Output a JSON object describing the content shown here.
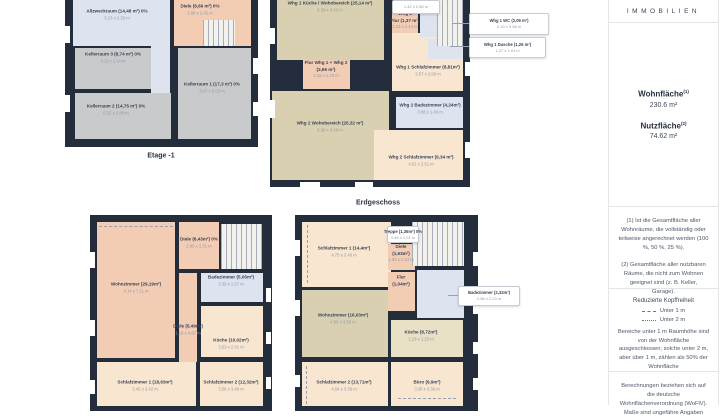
{
  "colors": {
    "wall": "#242d3c",
    "tan": "#d9d0b2",
    "tan_light": "#e9e1c6",
    "cream": "#f8e6d0",
    "salmon": "#f2cdb4",
    "blue": "#dde4f0",
    "gray": "#c9cacb"
  },
  "plans": [
    {
      "id": "etage-minus-1",
      "frame": [
        65,
        -6,
        193,
        153
      ],
      "rooms": [
        {
          "key": "allzweckraum",
          "color": "blue",
          "rect": [
            73,
            0,
            97,
            46
          ],
          "label_at": [
            117,
            15
          ],
          "name_lines": [
            "Allzweckraum (14,48 m²) 0%"
          ],
          "dim": "5.23 x 2.36 m"
        },
        {
          "key": "kellerflur",
          "color": "blue",
          "rect": [
            151,
            46,
            19,
            57
          ],
          "name_lines": []
        },
        {
          "key": "diele-keller",
          "color": "salmon",
          "rect": [
            174,
            0,
            77,
            46
          ],
          "label_at": [
            200,
            10
          ],
          "name_lines": [
            "Diele (8,69 m²) 0%"
          ],
          "dim": "2.88 x 2.42 m"
        },
        {
          "key": "kellerraum-3",
          "color": "gray",
          "rect": [
            75,
            48,
            76,
            41
          ],
          "label_at": [
            113,
            58
          ],
          "name_lines": [
            "Kellerraum 3 (8,74 m²) 0%"
          ],
          "dim": "4.11 x 2.14 m"
        },
        {
          "key": "kellerraum-1",
          "color": "gray",
          "rect": [
            178,
            48,
            73,
            91
          ],
          "label_at": [
            212,
            88
          ],
          "name_lines": [
            "Kellerraum 1 (17,3 m²) 0%"
          ],
          "dim": "3.47 x 5.03 m"
        },
        {
          "key": "kellerraum-2",
          "color": "gray",
          "rect": [
            75,
            93,
            96,
            46
          ],
          "label_at": [
            116,
            110
          ],
          "name_lines": [
            "Kellerraum 2 (14,75 m²) 0%"
          ],
          "dim": "5.25 x 2.80 m"
        }
      ],
      "stairs": [
        [
          203,
          20,
          32,
          26
        ]
      ],
      "windows": [
        [
          65,
          26,
          5,
          17
        ],
        [
          65,
          95,
          5,
          17
        ],
        [
          253,
          58,
          5,
          16
        ],
        [
          253,
          102,
          5,
          14
        ]
      ]
    },
    {
      "id": "erdgeschoss",
      "frame": [
        270,
        -6,
        200,
        193
      ],
      "rooms": [
        {
          "key": "whg1-kueche-wohnbereich",
          "color": "tan",
          "rect": [
            277,
            0,
            107,
            60
          ],
          "label_at": [
            330,
            7
          ],
          "name_lines": [
            "Whg 1 Küche / Wohnbereich (25,14 m²)"
          ],
          "dim": "5.39 x 4.63 m"
        },
        {
          "key": "whg1-schlafzimmer",
          "color": "cream",
          "rect": [
            392,
            33,
            71,
            58
          ],
          "label_at": [
            428,
            71
          ],
          "name_lines": [
            "Whg 1 Schlafzimmer (8,81m²)"
          ],
          "dim": "3.57 x 2.89 m"
        },
        {
          "key": "whg1-wc",
          "color": "blue",
          "rect": [
            420,
            13,
            43,
            24
          ],
          "name_lines": []
        },
        {
          "key": "whg1-dusche",
          "color": "blue",
          "rect": [
            428,
            39,
            35,
            20
          ],
          "name_lines": []
        },
        {
          "key": "whg1-flur",
          "color": "salmon",
          "rect": [
            392,
            13,
            26,
            20
          ],
          "label_at": [
            405,
            21
          ],
          "name_lines": [
            "Whg 1",
            "Flur (1,37 m²)"
          ],
          "dim": "1.22 x 1.14 m"
        },
        {
          "key": "flur-whg1-whg2",
          "color": "salmon",
          "rect": [
            303,
            60,
            47,
            29
          ],
          "label_at": [
            326,
            70
          ],
          "name_lines": [
            "Flur Whg 1 + Whg 2",
            "(2,66 m²)"
          ],
          "dim": "2.18 x 1.23 m"
        },
        {
          "key": "whg2-wohnbereich",
          "color": "tan",
          "rect": [
            272,
            91,
            117,
            89
          ],
          "label_at": [
            330,
            127
          ],
          "name_lines": [
            "Whg 2 Wohnbereich (25,32 m²)"
          ],
          "dim": "5.36 x 4.59 m"
        },
        {
          "key": "whg2-badezimmer",
          "color": "blue",
          "rect": [
            396,
            97,
            67,
            31
          ],
          "label_at": [
            430,
            109
          ],
          "name_lines": [
            "Whg 2 Badezimmer (4,24m²)"
          ],
          "dim": "3.08 x 1.49 m"
        },
        {
          "key": "whg2-schlafzimmer",
          "color": "cream",
          "rect": [
            374,
            130,
            89,
            50
          ],
          "label_at": [
            421,
            161
          ],
          "name_lines": [
            "Whg 2 Schlafzimmer (9,34 m²)"
          ],
          "dim": "4.51 x 2.51 m"
        }
      ],
      "stairs": [
        [
          437,
          0,
          26,
          46
        ]
      ],
      "windows": [
        [
          270,
          28,
          5,
          16
        ],
        [
          270,
          100,
          5,
          18
        ],
        [
          465,
          62,
          5,
          14
        ],
        [
          465,
          142,
          5,
          16
        ],
        [
          300,
          182,
          20,
          5
        ],
        [
          355,
          182,
          18,
          5
        ]
      ]
    },
    {
      "id": "obergeschoss-links",
      "frame": [
        90,
        215,
        182,
        196
      ],
      "rooms": [
        {
          "key": "wohnzimmer-og1",
          "color": "salmon",
          "rect": [
            97,
            222,
            78,
            136
          ],
          "label_at": [
            136,
            288
          ],
          "name_lines": [
            "Wohnzimmer (29,19m²)"
          ],
          "dim": "4.14 x 7.11 m"
        },
        {
          "key": "diele-643",
          "color": "salmon",
          "rect": [
            179,
            222,
            40,
            47
          ],
          "label_at": [
            199,
            243
          ],
          "name_lines": [
            "Diele (6,43m²) 0%"
          ],
          "dim": "2.95 x 2.31 m"
        },
        {
          "key": "diele-549",
          "color": "salmon",
          "rect": [
            179,
            273,
            18,
            89
          ],
          "label_at": [
            188,
            330
          ],
          "name_lines": [
            "Diele (5,49m²)"
          ],
          "dim": "1.18 x 4.67 m"
        },
        {
          "key": "badezimmer-og1",
          "color": "blue",
          "rect": [
            201,
            273,
            62,
            29
          ],
          "label_at": [
            231,
            281
          ],
          "name_lines": [
            "Badezimmer (5,05m²)"
          ],
          "dim": "3.30 x 1.57 m"
        },
        {
          "key": "kueche-og1",
          "color": "cream",
          "rect": [
            201,
            306,
            62,
            51
          ],
          "label_at": [
            231,
            344
          ],
          "name_lines": [
            "Küche (10,02m²)"
          ],
          "dim": "3.53 x 2.91 m"
        },
        {
          "key": "schlafzimmer-1-og1",
          "color": "cream",
          "rect": [
            97,
            362,
            99,
            44
          ],
          "label_at": [
            145,
            386
          ],
          "name_lines": [
            "Schlafzimmer 1 (18,63m²)"
          ],
          "dim": "5.45 x 3.42 m"
        },
        {
          "key": "schlafzimmer-2-og1",
          "color": "cream",
          "rect": [
            200,
            362,
            63,
            44
          ],
          "label_at": [
            231,
            386
          ],
          "name_lines": [
            "Schlafzimmer 2 (12,32m²)"
          ],
          "dim": "3.58 x 3.49 m"
        }
      ],
      "stairs": [
        [
          221,
          224,
          41,
          45
        ]
      ],
      "windows": [
        [
          90,
          252,
          5,
          16
        ],
        [
          90,
          320,
          5,
          16
        ],
        [
          90,
          380,
          5,
          14
        ],
        [
          266,
          288,
          5,
          14
        ],
        [
          266,
          332,
          5,
          12
        ],
        [
          266,
          377,
          5,
          12
        ]
      ],
      "dashes": [
        [
          99,
          226,
          74,
          0
        ]
      ]
    },
    {
      "id": "obergeschoss-rechts",
      "frame": [
        295,
        215,
        183,
        196
      ],
      "rooms": [
        {
          "key": "schlafzimmer-1-og2",
          "color": "cream",
          "rect": [
            302,
            222,
            89,
            65
          ],
          "label_at": [
            344,
            252
          ],
          "name_lines": [
            "Schlafzimmer 1 (14,4m²)"
          ],
          "dim": "4.75 x 3.48 m"
        },
        {
          "key": "diele-og2",
          "color": "salmon",
          "rect": [
            388,
            244,
            27,
            26
          ],
          "label_at": [
            401,
            254
          ],
          "name_lines": [
            "Diele",
            "(1,63m²)"
          ],
          "dim": "1.31 x 1.24 m"
        },
        {
          "key": "flur-og2",
          "color": "salmon",
          "rect": [
            388,
            272,
            27,
            39
          ],
          "label_at": [
            401,
            281
          ],
          "name_lines": [
            "Flur",
            "(1,04m²)"
          ]
        },
        {
          "key": "badezimmer-og2",
          "color": "blue",
          "rect": [
            417,
            270,
            47,
            48
          ],
          "name_lines": []
        },
        {
          "key": "wohnzimmer-og2",
          "color": "tan",
          "rect": [
            302,
            290,
            86,
            67
          ],
          "label_at": [
            343,
            319
          ],
          "name_lines": [
            "Wohnzimmer (16,03m²)"
          ],
          "dim": "4.56 x 3.56 m"
        },
        {
          "key": "kueche-og2",
          "color": "tan_light",
          "rect": [
            391,
            320,
            72,
            37
          ],
          "label_at": [
            421,
            336
          ],
          "name_lines": [
            "Küche (8,72m²)"
          ],
          "dim": "1.23 x 1.23 m"
        },
        {
          "key": "schlafzimmer-2-og2",
          "color": "cream",
          "rect": [
            302,
            362,
            86,
            44
          ],
          "label_at": [
            344,
            386
          ],
          "name_lines": [
            "Schlafzimmer 2 (13,71m²)"
          ],
          "dim": "4.54 x 3.38 m"
        },
        {
          "key": "buero",
          "color": "cream",
          "rect": [
            391,
            362,
            72,
            44
          ],
          "label_at": [
            427,
            386
          ],
          "name_lines": [
            "Büro (9,9m²)"
          ],
          "dim": "3.30 x 3.36 m"
        }
      ],
      "stairs": [
        [
          412,
          222,
          52,
          44
        ]
      ],
      "windows": [
        [
          295,
          240,
          5,
          16
        ],
        [
          295,
          300,
          5,
          16
        ],
        [
          295,
          375,
          5,
          12
        ],
        [
          473,
          252,
          5,
          14
        ],
        [
          473,
          300,
          5,
          14
        ],
        [
          473,
          342,
          5,
          12
        ],
        [
          473,
          378,
          5,
          12
        ]
      ],
      "dashes": [
        [
          307,
          225,
          0,
          58
        ],
        [
          306,
          366,
          0,
          38
        ],
        [
          398,
          398,
          58,
          0
        ]
      ]
    }
  ],
  "callouts": [
    {
      "name": "Whg 1 WC (2,09 m²)",
      "dim": "2.19 x 0.98 m",
      "rect": [
        469,
        13,
        78,
        20
      ],
      "leader": [
        452,
        23,
        17
      ]
    },
    {
      "name": "Whg 1 Dusche (1,26 m²)",
      "dim": "1.27 x 1.01 m",
      "rect": [
        469,
        37,
        75,
        19
      ],
      "leader": [
        450,
        46,
        19
      ]
    },
    {
      "name": "",
      "dim": "1.42 x 2.80 m",
      "rect": [
        392,
        0,
        46,
        12
      ]
    },
    {
      "name": "Treppe (1,35m²) 0%",
      "dim": "1.46 x 1.01 m",
      "rect": [
        387,
        226,
        30,
        15
      ]
    },
    {
      "name": "Badezimmer (2,32m²)",
      "dim": "1.58 x 2.23 m",
      "rect": [
        458,
        286,
        60,
        18
      ],
      "leader": [
        448,
        295,
        10
      ]
    }
  ],
  "floor_labels": [
    {
      "text": "Etage -1",
      "at": [
        161,
        156
      ]
    },
    {
      "text": "Erdgeschoss",
      "at": [
        378,
        203
      ]
    }
  ],
  "sidebar": {
    "brand": "IMMOBILIEN",
    "wohnflaeche_label": "Wohnfläche",
    "wohnflaeche_sup": "(1)",
    "wohnflaeche_value": "230.6 m²",
    "nutzflaeche_label": "Nutzfläche",
    "nutzflaeche_sup": "(2)",
    "nutzflaeche_value": "74.62 m²",
    "note1": "(1) Ist die Gesamtfläche aller Wohnräume, die vollständig oder teilweise angerechnet werden (100 %, 50 %, 25 %).",
    "note2": "(2) Gesamtfläche aller nutzbaren Räume, die nicht zum Wohnen geeignet sind (z. B. Keller, Garage).",
    "kopffreiheit_title": "Reduzierte Kopffreiheit",
    "legend": [
      {
        "style": "dashed",
        "label": "Unter 1 m"
      },
      {
        "style": "dotted",
        "label": "Unter 2 m"
      }
    ],
    "kopffreiheit_text": "Bereiche unter 1 m Raumhöhe sind von der Wohnfläche ausgeschlossen; solche unter 2 m, aber über 1 m, zählen als 50% der Wohnfläche",
    "footer": "Berechnungen beziehen sich auf die deutsche Wohnflächenverordnung (WoFlV). Maße sind ungefähre Angaben"
  }
}
